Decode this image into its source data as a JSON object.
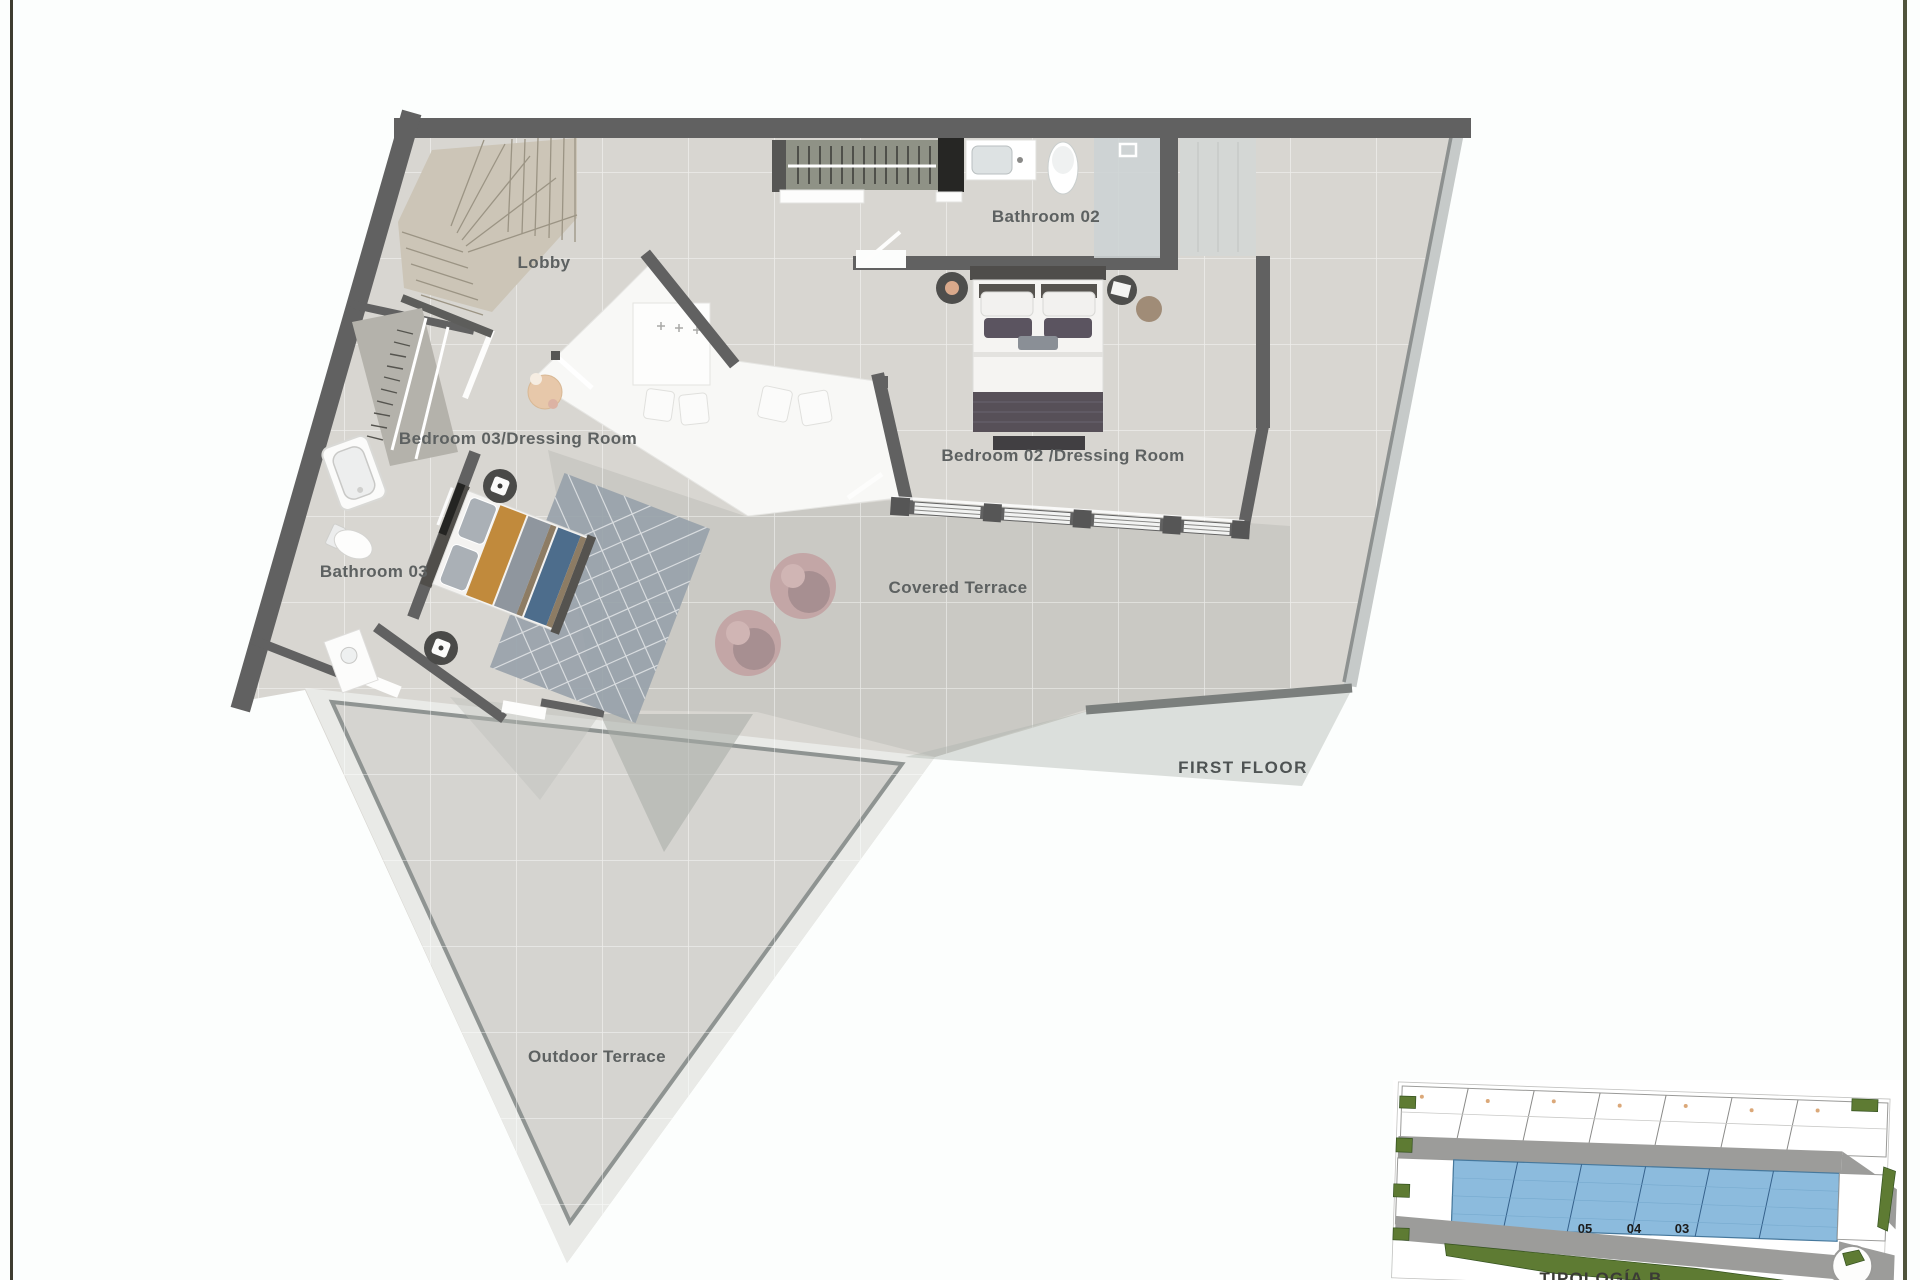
{
  "page": {
    "background": "#fcfefd",
    "frame_left_color": "#3e3c30",
    "frame_right_color": "#50543c"
  },
  "plan": {
    "title": "FIRST FLOOR",
    "rooms": [
      {
        "id": "lobby",
        "label": "Lobby"
      },
      {
        "id": "bathroom-02",
        "label": "Bathroom 02"
      },
      {
        "id": "bedroom-03",
        "label": "Bedroom 03/Dressing Room"
      },
      {
        "id": "bedroom-02",
        "label": "Bedroom 02 /Dressing Room"
      },
      {
        "id": "bathroom-03",
        "label": "Bathroom 03"
      },
      {
        "id": "covered-terrace",
        "label": "Covered Terrace"
      },
      {
        "id": "outdoor-terrace",
        "label": "Outdoor Terrace"
      }
    ],
    "colors": {
      "wall": "#616161",
      "floor_tile": "#d8d6d1",
      "covered_terrace_tile": "#cac9c4",
      "outdoor_terrace_tile": "#d5d4d0",
      "void_floor": "#f8f8f6",
      "stairs": "#ccc5b7",
      "closet": "#8f9286",
      "bed_orange": "#c18a3c",
      "bed_blue": "#4d6d8c",
      "bed_purple": "#5b5460",
      "rug": "#99a2ab",
      "beanbag": "#c3a6a6",
      "glass": "#c6cac9"
    }
  },
  "site_inset": {
    "title": "TIPOLOGÍA B",
    "unit_numbers": [
      "05",
      "04",
      "03"
    ],
    "highlight_color": "#8cbbdd",
    "road_color": "#9c9c9a",
    "green_color": "#5e7b33"
  }
}
